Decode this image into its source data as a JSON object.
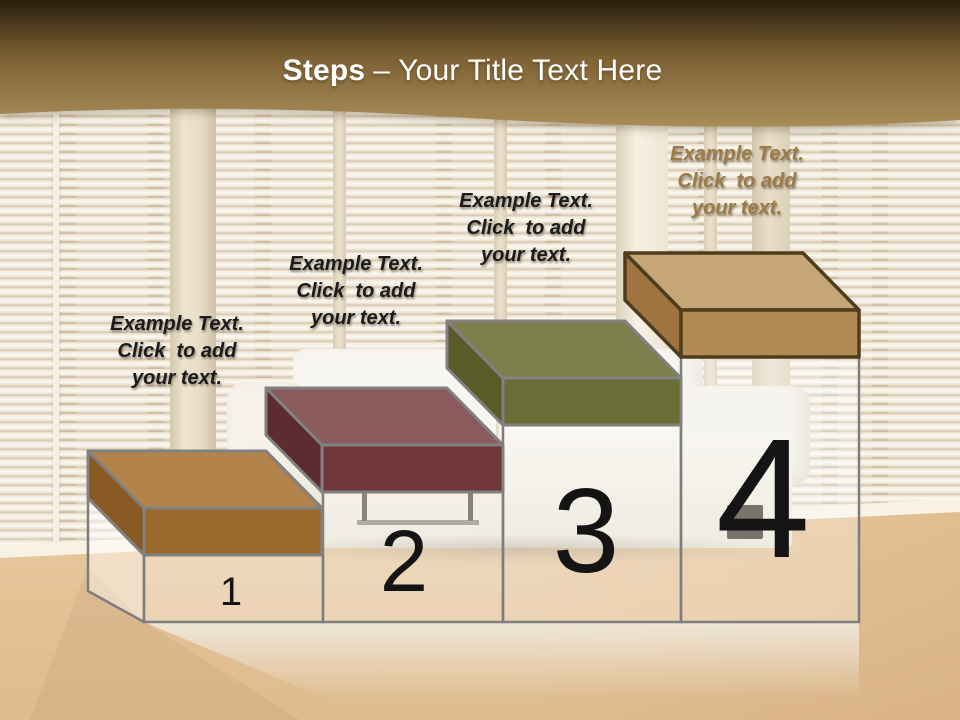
{
  "header": {
    "title_bold": "Steps",
    "title_rest": "– Your Title Text Here",
    "text_color": "#ffffff",
    "band_top_color": "#271e0c",
    "band_mid_color": "#7d6134",
    "band_bottom_color": "#a98d58"
  },
  "pedestal": {
    "fill": "rgba(255,255,255,0.30)",
    "left_face_fill": "rgba(255,255,255,0.45)",
    "outline": "#7d7d7d",
    "number_color": "#141414"
  },
  "steps": [
    {
      "number": "1",
      "label": "Example Text.\nClick  to add\nyour text.",
      "label_color": "#1b1b1b",
      "colors": {
        "top": "#b3834c",
        "side": "#8a5a24",
        "front": "#9c692d",
        "outline": "#818181"
      }
    },
    {
      "number": "2",
      "label": "Example Text.\nClick  to add\nyour text.",
      "label_color": "#1b1b1b",
      "colors": {
        "top": "#8a5a5c",
        "side": "#5c2c30",
        "front": "#6f373a",
        "outline": "#818181"
      }
    },
    {
      "number": "3",
      "label": "Example Text.\nClick  to add\nyour text.",
      "label_color": "#1b1b1b",
      "colors": {
        "top": "#7d804d",
        "side": "#585c29",
        "front": "#6a6d35",
        "outline": "#818181"
      }
    },
    {
      "number": "4",
      "label": "Example Text.\nClick  to add\nyour text.",
      "label_color": "#9b7b46",
      "colors": {
        "top": "#c6a676",
        "side": "#a07440",
        "front": "#b28b53",
        "outline": "#4f3c1c"
      }
    }
  ]
}
